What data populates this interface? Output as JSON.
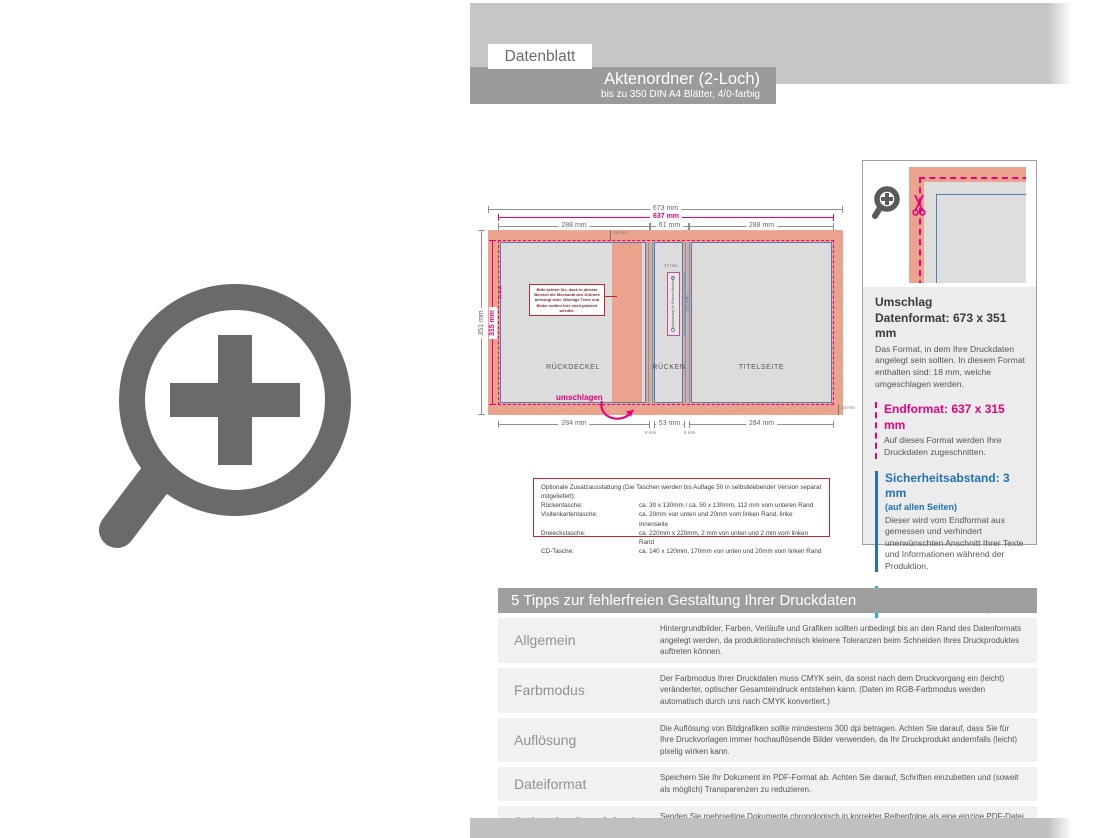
{
  "header": {
    "tab": "Datenblatt",
    "title": "Aktenordner (2-Loch)",
    "subtitle": "bis zu 350 DIN A4 Blätter, 4/0-farbig"
  },
  "diagram": {
    "dims": {
      "w_total": "673 mm",
      "w_trim": "637 mm",
      "w_left": "288 mm",
      "w_spine": "61 mm",
      "w_right": "288 mm",
      "h_total": "351 mm",
      "h_trim": "315 mm",
      "b_left": "284 mm",
      "b_spine": "53 mm",
      "b_right": "284 mm",
      "b_fold": "8 mm",
      "fold": "18 mm"
    },
    "panels": {
      "back": "RÜCKDECKEL",
      "spine": "RÜCKEN",
      "front": "TITELSEITE"
    },
    "fold_label": "umschlagen",
    "mech_note": "Bitte achten Sie, dass in diesem Bereich die Mechanik des Ordners befestigt wird. Wichtige Texte und Bilder sollten hier nicht platziert werden.",
    "spine_slot": {
      "text": "Aussparung für Ordner-Mechanik",
      "dim_top": "17 mm",
      "dim_side": "192 mm"
    },
    "options": {
      "title": "Optionale Zusatzausstattung (Die Taschen werden bis Auflage 50 in selbstklebender Version separat mitgeliefert):",
      "rows": [
        {
          "name": "Rückentasche:",
          "spec": "ca. 30 x 130mm / ca. 50 x 130mm, 112 mm vom unteren Rand"
        },
        {
          "name": "Visitenkartentasche:",
          "spec": "ca. 20mm von unten und 20mm vom linken Rand, linke Innenseite"
        },
        {
          "name": "Dreieckstasche:",
          "spec": "ca. 220mm x 220mm, 2 mm von unten und 2 mm vom linken Rand"
        },
        {
          "name": "CD-Tasche:",
          "spec": "ca. 140 x 120mm, 170mm von unten und 20mm vom linken Rand"
        }
      ]
    }
  },
  "info_panel": {
    "umschlag": "Umschlag",
    "datenformat_title": "Datenformat: 673 x 351 mm",
    "datenformat_body": "Das Format, in dem Ihre Druckdaten angelegt sein sollten. In diesem Format enthalten sind: 18 mm, welche umgeschlagen werden.",
    "endformat_title": "Endformat: 637 x 315 mm",
    "endformat_body": "Auf dieses Format werden Ihre Druckdaten zugeschnitten.",
    "sicherheit_title": "Sicherheitsabstand: 3 mm",
    "sicherheit_sub": "(auf allen Seiten)",
    "sicherheit_body": "Dieser wird vom Endformat aus gemessen und verhindert unerwünschten Anschnitt Ihrer Texte und Informationen während der Produktion.",
    "falz_title": "Falzlinien",
    "falz_body": "Hier befinden sich die Falzpositionen in Ihrem Produkt."
  },
  "tips": {
    "header": "5 Tipps zur fehlerfreien Gestaltung Ihrer Druckdaten",
    "rows": [
      {
        "label": "Allgemein",
        "text": "Hintergrundbilder, Farben, Verläufe und Grafiken sollten unbedingt bis an den Rand des Datenformats angelegt werden, da produktionstechnisch kleinere Toleranzen beim Schneiden Ihres Druckproduktes auftreten können."
      },
      {
        "label": "Farbmodus",
        "text": "Der Farbmodus Ihrer Druckdaten muss CMYK sein, da sonst nach dem Druckvorgang ein (leicht) veränderter, optischer Gesamteindruck entstehen kann. (Daten im RGB-Farbmodus werden automatisch durch uns nach CMYK konvertiert.)"
      },
      {
        "label": "Auflösung",
        "text": "Die Auflösung von Bildgrafiken sollte mindestens 300 dpi betragen. Achten Sie darauf, dass Sie für Ihre Druckvorlagen immer hochauflösende Bilder verwenden, da Ihr Druckprodukt andernfalls (leicht) pixelig wirken kann."
      },
      {
        "label": "Dateiformat",
        "text": "Speichern Sie Ihr Dokument im PDF-Format ab. Achten Sie darauf, Schriften einzubetten und (soweit als möglich) Transparenzen zu reduzieren."
      },
      {
        "label": "Seiten(-reihenfolge)",
        "text": "Senden Sie mehrseitige Dokumente chronologisch in korrekter Reihenfolge als eine einzige PDF-Datei oder benennen Sie Einzeldokumente entsprechend mit fortlaufenden Seitennummern."
      }
    ]
  },
  "colors": {
    "bleed_salmon": "#eaa48e",
    "trim_magenta": "#e5007d",
    "safety_blue": "#2272b4",
    "fold_cyan": "#29abe2"
  }
}
